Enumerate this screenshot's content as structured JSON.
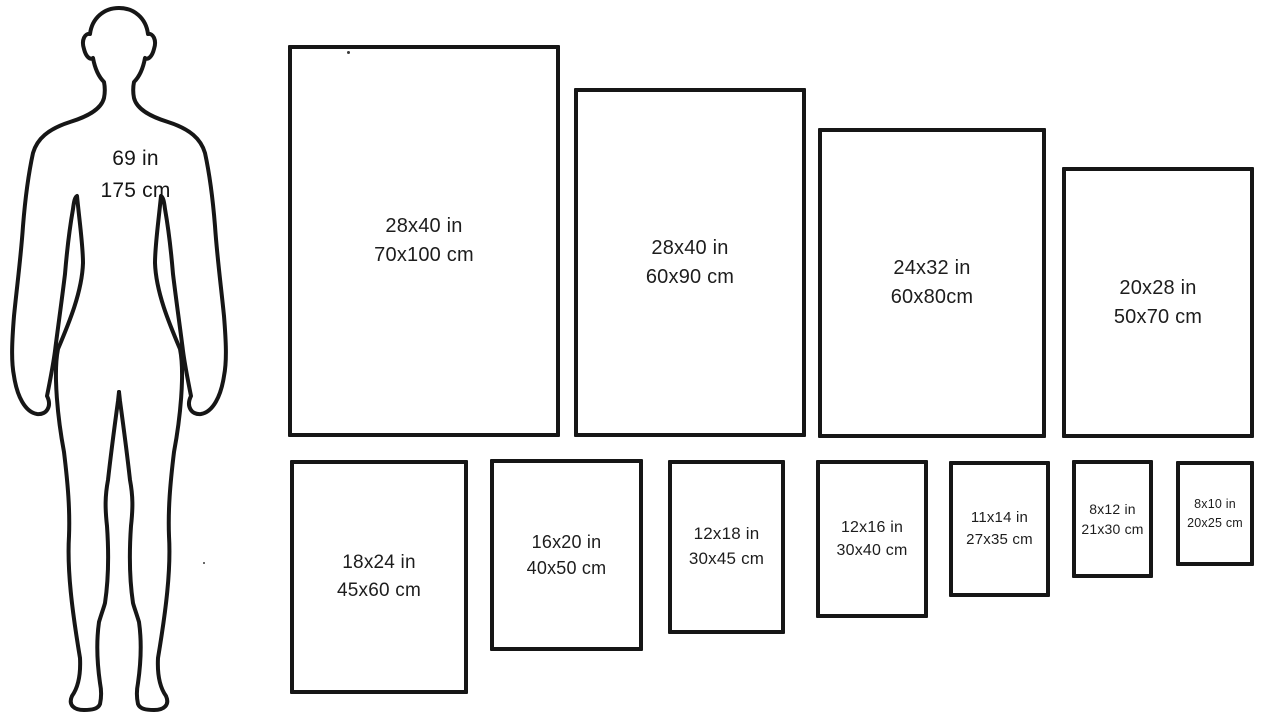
{
  "human": {
    "height_in": "69 in",
    "height_cm": "175 cm"
  },
  "posters": {
    "top_row": [
      {
        "inches": "28x40 in",
        "metric": "70x100 cm"
      },
      {
        "inches": "28x40 in",
        "metric": "60x90 cm"
      },
      {
        "inches": "24x32 in",
        "metric": "60x80cm"
      },
      {
        "inches": "20x28 in",
        "metric": "50x70 cm"
      }
    ],
    "bottom_row": [
      {
        "inches": "18x24 in",
        "metric": "45x60 cm"
      },
      {
        "inches": "16x20 in",
        "metric": "40x50 cm"
      },
      {
        "inches": "12x18 in",
        "metric": "30x45 cm"
      },
      {
        "inches": "12x16 in",
        "metric": "30x40 cm"
      },
      {
        "inches": "11x14 in",
        "metric": "27x35 cm"
      },
      {
        "inches": "8x12 in",
        "metric": "21x30 cm"
      },
      {
        "inches": "8x10 in",
        "metric": "20x25 cm"
      }
    ]
  },
  "colors": {
    "outline": "#161616",
    "background": "#ffffff",
    "text": "#1d1d1d"
  }
}
